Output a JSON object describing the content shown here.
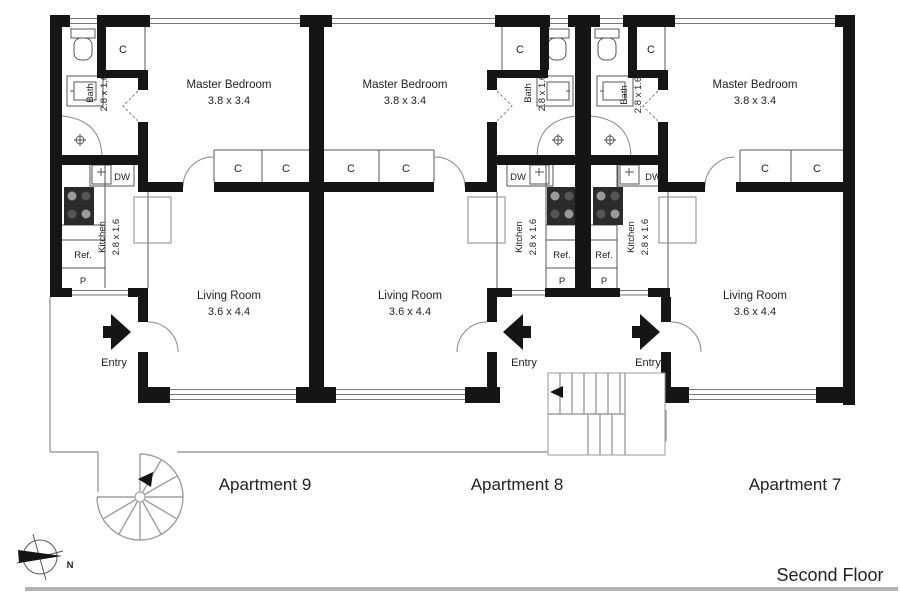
{
  "floor_plan": {
    "floor_label": "Second Floor",
    "compass": {
      "north_label": "N"
    },
    "apartments": [
      {
        "name": "Apartment 9",
        "rooms": {
          "master_bedroom": {
            "label": "Master Bedroom",
            "dims": "3.8 x 3.4"
          },
          "bath": {
            "label": "Bath",
            "dims": "2.8 x 1.6"
          },
          "kitchen": {
            "label": "Kitchen",
            "dims": "2.8 x 1.6"
          },
          "living_room": {
            "label": "Living Room",
            "dims": "3.6 x 4.4"
          }
        },
        "labels": {
          "closet": "C",
          "dishwasher": "DW",
          "refrigerator": "Ref.",
          "pantry": "P",
          "entry": "Entry"
        }
      },
      {
        "name": "Apartment 8",
        "rooms": {
          "master_bedroom": {
            "label": "Master Bedroom",
            "dims": "3.8 x 3.4"
          },
          "bath": {
            "label": "Bath",
            "dims": "2.8 x 1.6"
          },
          "kitchen": {
            "label": "Kitchen",
            "dims": "2.8 x 1.6"
          },
          "living_room": {
            "label": "Living Room",
            "dims": "3.6 x 4.4"
          }
        },
        "labels": {
          "closet": "C",
          "dishwasher": "DW",
          "refrigerator": "Ref.",
          "pantry": "P",
          "entry": "Entry"
        }
      },
      {
        "name": "Apartment 7",
        "rooms": {
          "master_bedroom": {
            "label": "Master Bedroom",
            "dims": "3.8 x 3.4"
          },
          "bath": {
            "label": "Bath",
            "dims": "2.8 x 1.6"
          },
          "kitchen": {
            "label": "Kitchen",
            "dims": "2.8 x 1.6"
          },
          "living_room": {
            "label": "Living Room",
            "dims": "3.6 x 4.4"
          }
        },
        "labels": {
          "closet": "C",
          "dishwasher": "DW",
          "refrigerator": "Ref.",
          "pantry": "P",
          "entry": "Entry"
        }
      }
    ]
  }
}
